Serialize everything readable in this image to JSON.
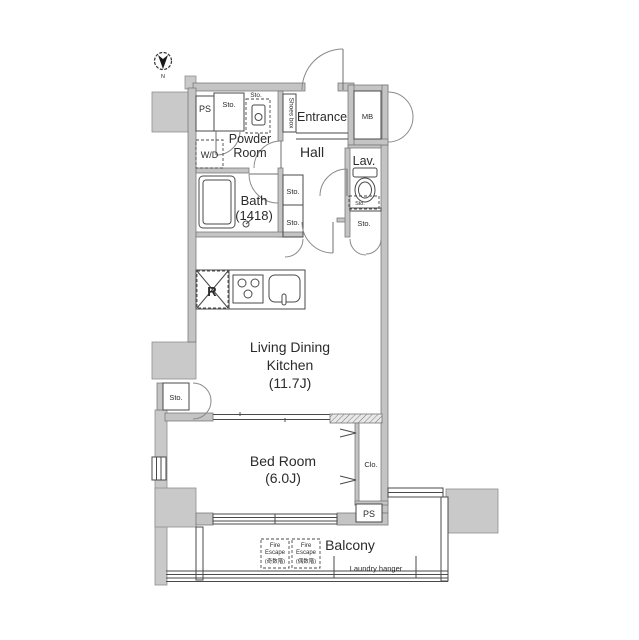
{
  "compass": {
    "north": "N"
  },
  "rooms": {
    "entrance": "Entrance",
    "hall": "Hall",
    "powder_room": [
      "Powder",
      "Room"
    ],
    "bath": [
      "Bath",
      "(1418)"
    ],
    "lavatory": "Lav.",
    "living_dining_kitchen": [
      "Living Dining",
      "Kitchen",
      "(11.7J)"
    ],
    "bed_room": [
      "Bed Room",
      "(6.0J)"
    ],
    "balcony": "Balcony"
  },
  "fixtures": {
    "shoes_box": "Shoes box",
    "meter_box": "MB",
    "pipe_space_top": "PS",
    "pipe_space_bottom": "PS",
    "washer_dryer": "W/D",
    "refrigerator": "R",
    "closet": "Clo.",
    "laundry_hanger": "Laundry hanger"
  },
  "storage": {
    "sto_top": "Sto.",
    "sto_water_heater": "Sto.",
    "sto_hall_upper": "Sto.",
    "sto_hall_lower": "Sto.",
    "sto_lav_shelf": "Sto.",
    "sto_lav_lower": "Sto.",
    "sto_ldk": "Sto."
  },
  "fire_escape_odd": [
    "Fire",
    "Escape",
    "(奇数階)"
  ],
  "fire_escape_even": [
    "Fire",
    "Escape",
    "(偶数階)"
  ],
  "colors": {
    "wall_fill": "#c4c4c4",
    "block_fill": "#c9c9c9",
    "line": "#4a4a4a",
    "text": "#2b2b2b",
    "background": "#ffffff"
  }
}
